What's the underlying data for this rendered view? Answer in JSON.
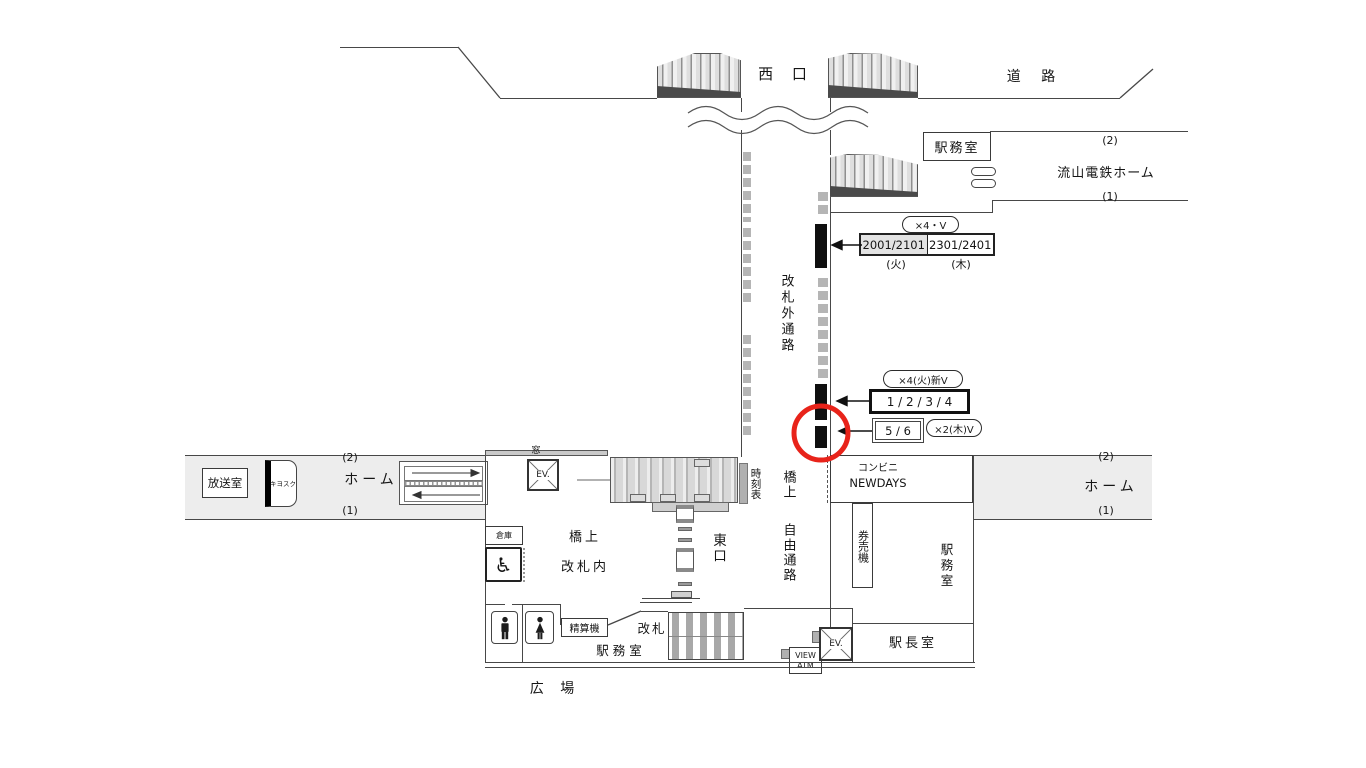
{
  "plan": {
    "west_exit": "西 口",
    "road": "道 路",
    "office_top": "駅務室",
    "nagareyama": {
      "track2": "(2)",
      "name": "流山電鉄ホーム",
      "track1": "(1)"
    },
    "corridor_label": "改札外通路",
    "signs": {
      "g1_tag": "×4・V",
      "g1_left": "2001/2101",
      "g1_right": "2301/2401",
      "g1_day_left": "(火)",
      "g1_day_right": "(木)",
      "g2_tag": "×4(火)新V",
      "g2_box": "1 / 2 / 3 / 4",
      "g3_box": "5 / 6",
      "g3_tag": "×2(木)V"
    },
    "west_platform": {
      "broadcast": "放送室",
      "kiosk": "キヨスク",
      "track2": "(2)",
      "home": "ホーム",
      "track1": "(1)"
    },
    "bridge": {
      "window": "窓",
      "ev": "EV.",
      "timetable": "時刻表",
      "kyojo": "橋上",
      "inside_gate": "改札内",
      "east_exit": "東口",
      "free_kyojo": "橋上",
      "free_passage": "自由通路",
      "storage": "倉庫",
      "wheelchair": "♿"
    },
    "east_side": {
      "conbini": "コンビニ",
      "newdays": "NEWDAYS",
      "ticket_machine": "券売機",
      "office": "駅務室",
      "track2": "(2)",
      "home": "ホーム",
      "track1": "(1)"
    },
    "south": {
      "fare_adjust": "精算機",
      "gate": "改札",
      "office": "駅 務 室",
      "view": "VIEW",
      "atm": "ATM",
      "ev": "EV.",
      "master": "駅長室",
      "plaza": "広 場"
    }
  },
  "colors": {
    "highlight_circle": "#e8231a"
  }
}
